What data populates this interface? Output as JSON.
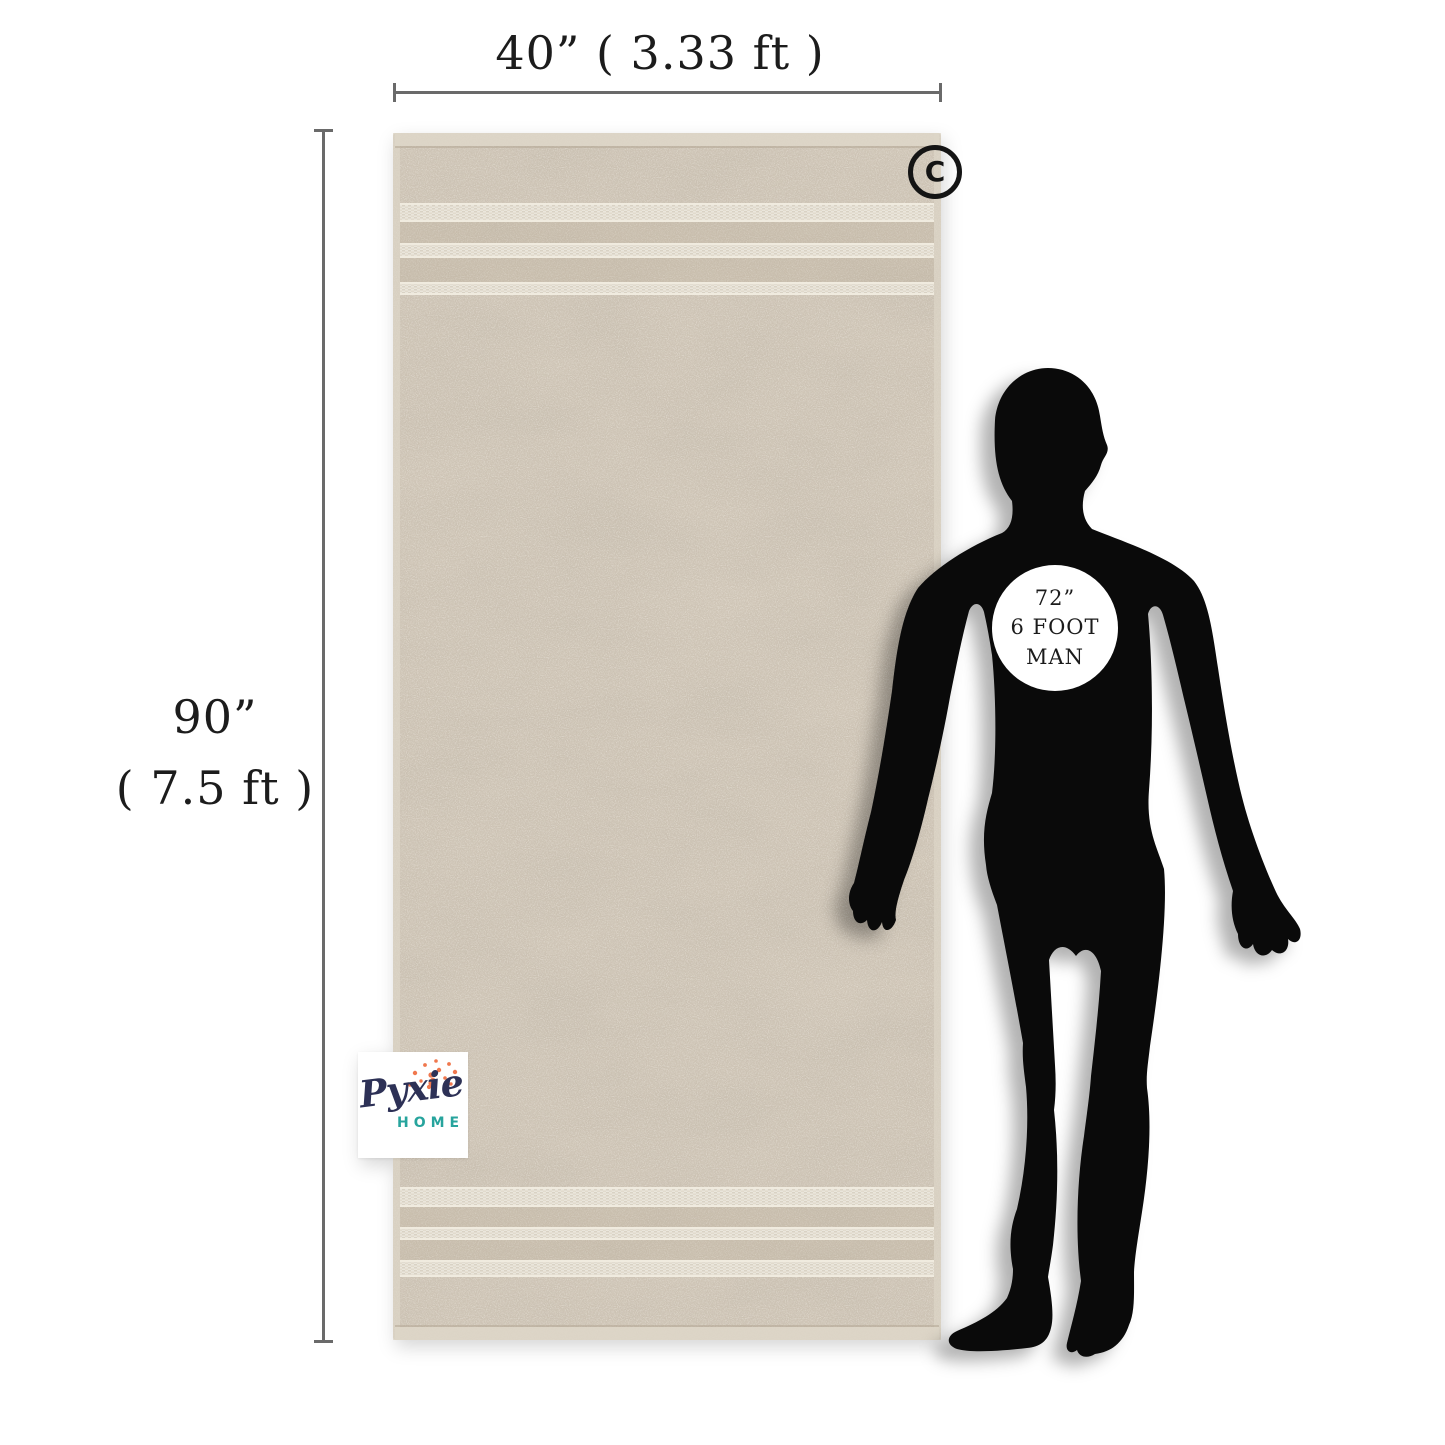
{
  "dimensions": {
    "width": {
      "label": "40” ( 3.33 ft )"
    },
    "height": {
      "inches": "90”",
      "feet": "( 7.5 ft )"
    }
  },
  "size_badge": {
    "line1": "72”",
    "line2": "6 FOOT",
    "line3": "MAN"
  },
  "watermark": {
    "brand": "Pyxie",
    "sub_brand": "HOME"
  },
  "copyright_mark": {
    "letter": "C"
  },
  "colors": {
    "background": "#ffffff",
    "towel_base": "#cfc5b6",
    "towel_stripe": "#e1dacc",
    "towel_hem": "#ddd6c8",
    "silhouette_black": "#0a0a0a",
    "dimension_line_gray": "#6a6a6a",
    "label_text": "#1c1c1c",
    "logo_navy": "#2d3156",
    "logo_teal": "#27a49d",
    "logo_coral": "#f0784e"
  }
}
